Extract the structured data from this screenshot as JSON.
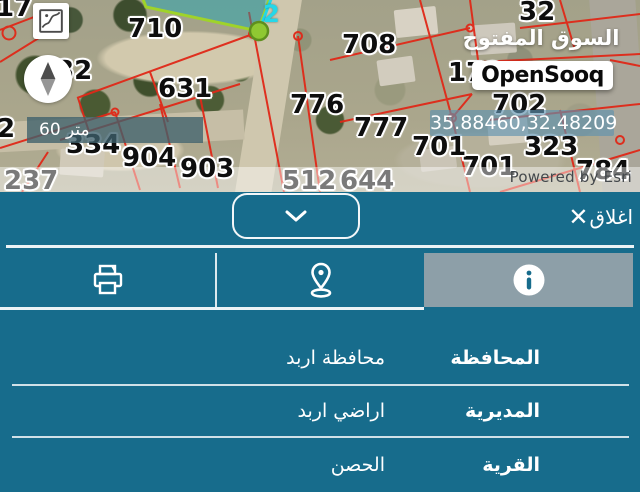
{
  "map": {
    "parcel_labels": [
      {
        "text": "710"
      },
      {
        "text": "632"
      },
      {
        "text": "631"
      },
      {
        "text": "708"
      },
      {
        "text": "32"
      },
      {
        "text": "173"
      },
      {
        "text": "702"
      },
      {
        "text": "776"
      },
      {
        "text": "777"
      },
      {
        "text": "701"
      },
      {
        "text": "323"
      },
      {
        "text": "904"
      },
      {
        "text": "903"
      },
      {
        "text": "334"
      },
      {
        "text": "17"
      },
      {
        "text": "2"
      }
    ],
    "faded_labels": [
      {
        "text": "237"
      },
      {
        "text": "512"
      },
      {
        "text": "644"
      },
      {
        "text": "701"
      },
      {
        "text": "784"
      }
    ],
    "marker_label": "2",
    "scale_bar": "60 متر",
    "coordinates": "35.88460,32.48209",
    "logo_arabic": "السوق المفتوح",
    "logo_latin": "OpenSooq",
    "attribution": "Powered by Esri",
    "icons": {
      "basemap_toggle": "basemap-map-outline",
      "compass": "north-compass-needle"
    }
  },
  "panel": {
    "close_label": "اغلاق",
    "close_icon": "✕",
    "tabs": [
      {
        "icon": "printer",
        "active": false
      },
      {
        "icon": "location-pin",
        "active": false
      },
      {
        "icon": "info",
        "active": true
      }
    ],
    "rows": [
      {
        "label": "المحافظة",
        "value": "محافظة اربد"
      },
      {
        "label": "المديرية",
        "value": "اراضي اربد"
      },
      {
        "label": "القرية",
        "value": "الحصن"
      }
    ],
    "colors": {
      "panel_teal": "#176c8c",
      "active_tab_gray": "#8d9fa8",
      "parcel_line_red": "#e02818",
      "selected_parcel_cyan": "#25d7e8",
      "marker_green": "#8fc832"
    }
  }
}
